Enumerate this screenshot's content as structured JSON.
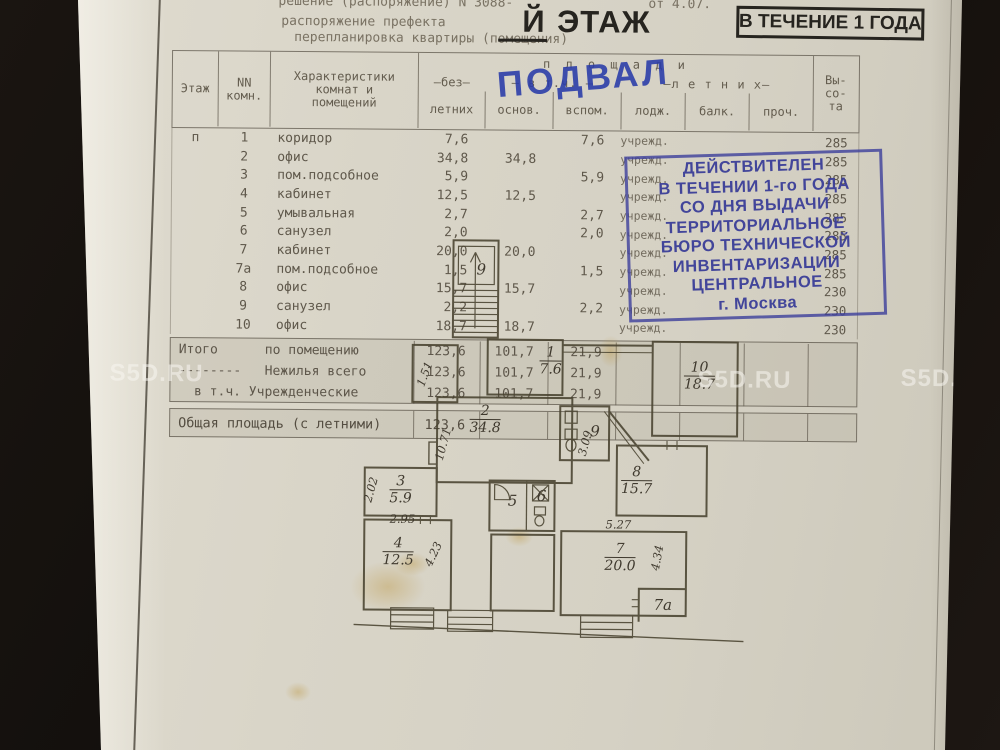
{
  "header": {
    "doc_line1_left": "решение (распоряжение) N 3088-",
    "doc_line1_right": "от 4.07.",
    "doc_line2": "распоряжение префекта",
    "doc_line3": "перепланировка квартиры (помещения)",
    "floor_title_letter": "Й",
    "floor_title_word": " ЭТАЖ",
    "validity_short": "В ТЕЧЕНИЕ 1 ГОДА"
  },
  "stamps": {
    "podval": "ПОДВАЛ",
    "ink_color": "#3a3d98",
    "validity_lines": [
      "ДЕЙСТВИТЕЛЕН",
      "В ТЕЧЕНИИ 1-го ГОДА",
      "СО ДНЯ ВЫДАЧИ",
      "ТЕРРИТОРИАЛЬНОЕ",
      "БЮРО ТЕХНИЧЕСКОЙ",
      "ИНВЕНТАРИЗАЦИИ",
      "ЦЕНТРАЛЬНОЕ",
      "г. Москва"
    ]
  },
  "table": {
    "col_headers": {
      "floor": "Этаж",
      "room_no": "NN\nкомн.",
      "characteristics": "Характеристики\nкомнат и\nпомещений",
      "areas_group": "п л о щ а д и",
      "without_summer_mid": "–без–",
      "without_summer_bot": "летних",
      "incl": "– в т.ч. –",
      "main": "основ.",
      "aux": "вспом.",
      "summer_group": "–л е т н и х–",
      "loggia": "лодж.",
      "balcony": "балк.",
      "other": "проч.",
      "height_lines": [
        "Вы-",
        "со-",
        "та"
      ]
    },
    "rows": [
      {
        "floor": "п",
        "num": "1",
        "name": "коридор",
        "total": "7,6",
        "main": "",
        "aux": "7,6",
        "use": "учрежд.",
        "height": "285"
      },
      {
        "floor": "",
        "num": "2",
        "name": "офис",
        "total": "34,8",
        "main": "34,8",
        "aux": "",
        "use": "учрежд.",
        "height": "285"
      },
      {
        "floor": "",
        "num": "3",
        "name": "пом.подсобное",
        "total": "5,9",
        "main": "",
        "aux": "5,9",
        "use": "учрежд.",
        "height": "285"
      },
      {
        "floor": "",
        "num": "4",
        "name": "кабинет",
        "total": "12,5",
        "main": "12,5",
        "aux": "",
        "use": "учрежд.",
        "height": "285"
      },
      {
        "floor": "",
        "num": "5",
        "name": "умывальная",
        "total": "2,7",
        "main": "",
        "aux": "2,7",
        "use": "учрежд.",
        "height": "285"
      },
      {
        "floor": "",
        "num": "6",
        "name": "санузел",
        "total": "2,0",
        "main": "",
        "aux": "2,0",
        "use": "учрежд.",
        "height": "285"
      },
      {
        "floor": "",
        "num": "7",
        "name": "кабинет",
        "total": "20,0",
        "main": "20,0",
        "aux": "",
        "use": "учрежд.",
        "height": "285"
      },
      {
        "floor": "",
        "num": "7а",
        "name": "пом.подсобное",
        "total": "1,5",
        "main": "",
        "aux": "1,5",
        "use": "учрежд.",
        "height": "285"
      },
      {
        "floor": "",
        "num": "8",
        "name": "офис",
        "total": "15,7",
        "main": "15,7",
        "aux": "",
        "use": "учрежд.",
        "height": "230"
      },
      {
        "floor": "",
        "num": "9",
        "name": "санузел",
        "total": "2,2",
        "main": "",
        "aux": "2,2",
        "use": "учрежд.",
        "height": "230"
      },
      {
        "floor": "",
        "num": "10",
        "name": "офис",
        "total": "18,7",
        "main": "18,7",
        "aux": "",
        "use": "учрежд.",
        "height": "230"
      }
    ],
    "summary_rows": [
      {
        "label": "Итого      по помещению",
        "total": "123,6",
        "main": "101,7",
        "aux": "21,9"
      },
      {
        "label": "--------   Нежилья всего",
        "total": "123,6",
        "main": "101,7",
        "aux": "21,9"
      },
      {
        "label": "  в т.ч. Учрежденческие",
        "total": "123,6",
        "main": "101,7",
        "aux": "21,9"
      }
    ],
    "total_area_row": {
      "label": "Общая площадь (с летними)",
      "value": "123,6"
    }
  },
  "plan": {
    "labels": [
      {
        "kind": "room",
        "text": "9",
        "x": 143,
        "y": 37
      },
      {
        "kind": "dim",
        "text": "1.51",
        "x": 87,
        "y": 142,
        "rot": -70
      },
      {
        "kind": "frac",
        "num": "1",
        "den": "7.6",
        "x": 213,
        "y": 128
      },
      {
        "kind": "frac",
        "num": "10",
        "den": "18.7",
        "x": 362,
        "y": 142
      },
      {
        "kind": "frac",
        "num": "2",
        "den": "34.8",
        "x": 148,
        "y": 187
      },
      {
        "kind": "dim",
        "text": "10.71",
        "x": 106,
        "y": 212,
        "rot": -75
      },
      {
        "kind": "dim",
        "text": "3.09",
        "x": 248,
        "y": 210,
        "rot": -75
      },
      {
        "kind": "room",
        "text": "9",
        "x": 258,
        "y": 198
      },
      {
        "kind": "frac",
        "num": "8",
        "den": "15.7",
        "x": 300,
        "y": 247
      },
      {
        "kind": "frac",
        "num": "3",
        "den": "5.9",
        "x": 64,
        "y": 258
      },
      {
        "kind": "dim",
        "text": "2.02",
        "x": 34,
        "y": 258,
        "rot": -75
      },
      {
        "kind": "dim",
        "text": "2.95",
        "x": 66,
        "y": 287
      },
      {
        "kind": "room",
        "text": "5",
        "x": 176,
        "y": 268
      },
      {
        "kind": "room",
        "text": "6",
        "x": 205,
        "y": 263
      },
      {
        "kind": "frac",
        "num": "4",
        "den": "12.5",
        "x": 62,
        "y": 320
      },
      {
        "kind": "dim",
        "text": "4.23",
        "x": 97,
        "y": 322,
        "rot": -65
      },
      {
        "kind": "dim",
        "text": "5.27",
        "x": 282,
        "y": 291
      },
      {
        "kind": "frac",
        "num": "7",
        "den": "20.0",
        "x": 284,
        "y": 324
      },
      {
        "kind": "dim",
        "text": "4.34",
        "x": 321,
        "y": 324,
        "rot": -80
      },
      {
        "kind": "room",
        "text": "7а",
        "x": 327,
        "y": 371
      }
    ]
  },
  "watermark": "S5D.RU"
}
